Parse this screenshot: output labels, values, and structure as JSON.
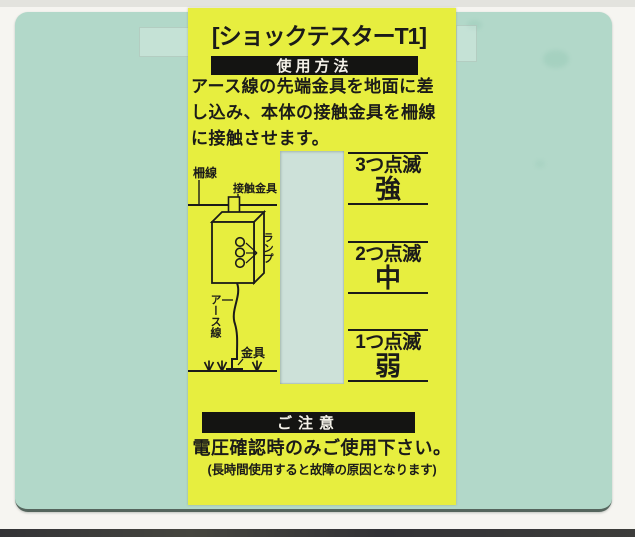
{
  "colors": {
    "card": "#b2d8c9",
    "label": "#e7ee3f",
    "bar": "#141412",
    "bar-text": "#f4f1e8",
    "ink": "#1b1b19",
    "window": "#cde1d9"
  },
  "label": {
    "title": "[ショックテスターT1]",
    "usage": {
      "heading": "使用方法",
      "body_lines": [
        "アース線の先端金具を地面に差",
        "し込み、本体の接触金具を柵線",
        "に接触させます。"
      ]
    },
    "diagram": {
      "fence_wire": "柵線",
      "contact_fitting": "接触金具",
      "lamp": "ランプ",
      "earth_wire": "アース線",
      "fitting": "金具"
    },
    "indicators": [
      {
        "blinks": "3つ点滅",
        "level": "強"
      },
      {
        "blinks": "2つ点滅",
        "level": "中"
      },
      {
        "blinks": "1つ点滅",
        "level": "弱"
      }
    ],
    "caution": {
      "heading": "ご注意",
      "line1": "電圧確認時のみご使用下さい。",
      "line2": "(長時間使用すると故障の原因となります)"
    }
  }
}
